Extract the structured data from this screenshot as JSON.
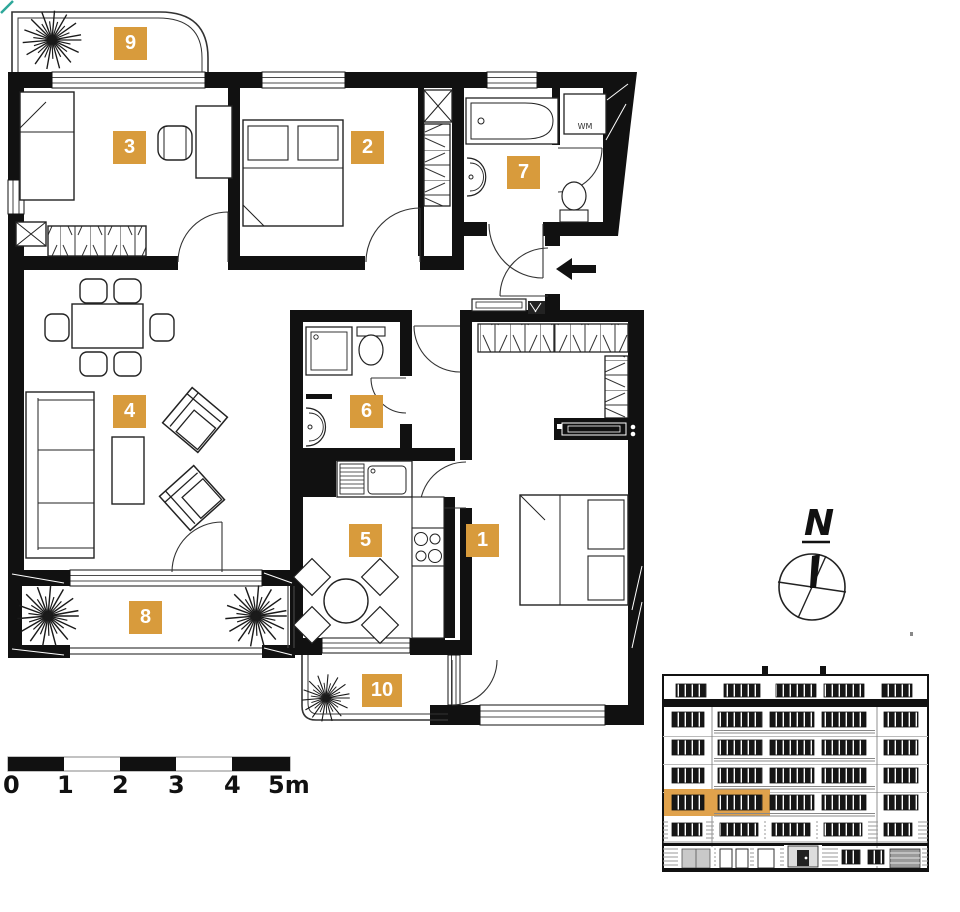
{
  "rooms": [
    {
      "number": "1"
    },
    {
      "number": "2"
    },
    {
      "number": "3"
    },
    {
      "number": "4"
    },
    {
      "number": "5"
    },
    {
      "number": "6"
    },
    {
      "number": "7"
    },
    {
      "number": "8"
    },
    {
      "number": "9"
    },
    {
      "number": "10"
    }
  ],
  "plan": {
    "washing_machine_label": "WM"
  },
  "compass": {
    "north_label": "N"
  },
  "scale_bar": {
    "labels": [
      "0",
      "1",
      "2",
      "3",
      "4",
      "5m"
    ]
  },
  "colors": {
    "room_badge": "#D89B3C",
    "walls": "#111111",
    "elevation_highlight": "#E0A24C",
    "corner_mark": "#2EA79A"
  }
}
